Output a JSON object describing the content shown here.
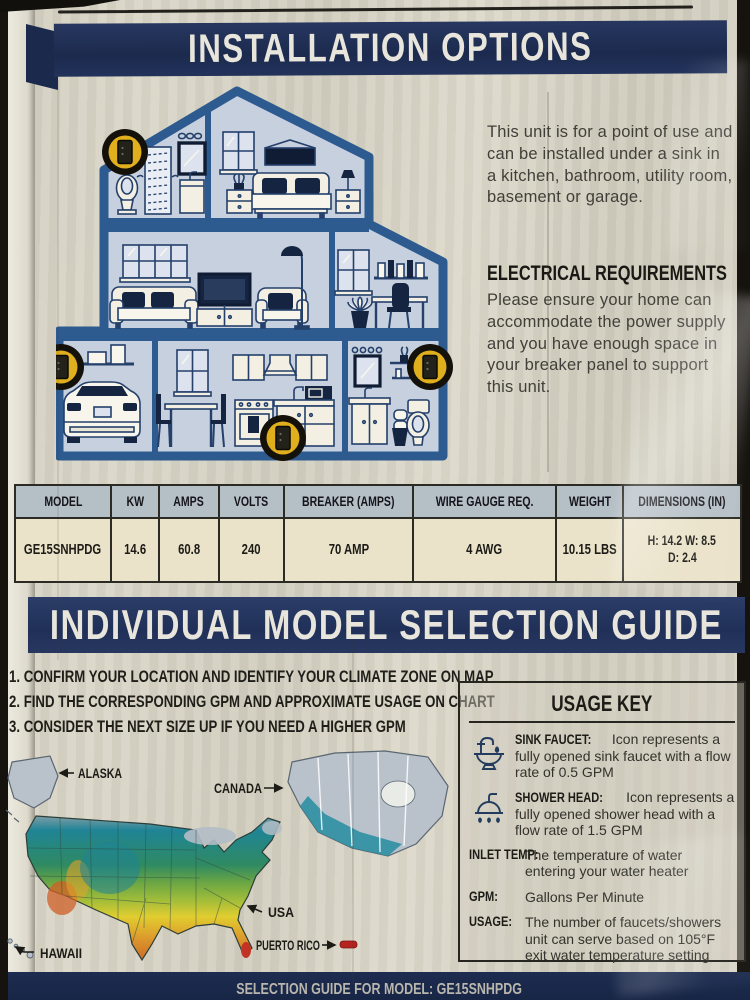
{
  "banners": {
    "installation": "INSTALLATION OPTIONS",
    "model_guide": "INDIVIDUAL MODEL SELECTION GUIDE",
    "bottom": "SELECTION GUIDE FOR MODEL: GE15SNHPDG"
  },
  "intro": {
    "text": "This unit is for a point of use and can be installed under a sink in a kitchen, bathroom, utility room, basement or garage."
  },
  "electrical": {
    "heading": "ELECTRICAL REQUIREMENTS",
    "text": "Please ensure your home can accommodate the power supply and you have enough space in your breaker panel to support this unit."
  },
  "spec_table": {
    "columns": [
      "MODEL",
      "KW",
      "AMPS",
      "VOLTS",
      "BREAKER (AMPS)",
      "WIRE GAUGE REQ.",
      "WEIGHT",
      "DIMENSIONS (IN)"
    ],
    "row": [
      "GE15SNHPDG",
      "14.6",
      "60.8",
      "240",
      "70 AMP",
      "4 AWG",
      "10.15 LBS"
    ],
    "dimensions": {
      "line1": "H: 14.2 W: 8.5",
      "line2": "D: 2.4"
    }
  },
  "steps": {
    "items": [
      {
        "num": "1.",
        "text": "CONFIRM YOUR LOCATION AND IDENTIFY YOUR CLIMATE ZONE ON MAP"
      },
      {
        "num": "2.",
        "text": "FIND THE CORRESPONDING GPM AND APPROXIMATE USAGE ON CHART"
      },
      {
        "num": "3.",
        "text": "CONSIDER THE NEXT SIZE UP IF YOU NEED A HIGHER GPM"
      }
    ]
  },
  "map": {
    "labels": {
      "alaska": "ALASKA",
      "canada": "CANADA",
      "usa": "USA",
      "puerto_rico": "PUERTO RICO",
      "hawaii": "HAWAII"
    }
  },
  "usage_key": {
    "title": "USAGE KEY",
    "items": [
      {
        "icon": "sink-faucet",
        "label": "SINK FAUCET:",
        "text": "Icon represents a fully opened sink faucet with a flow rate of 0.5 GPM"
      },
      {
        "icon": "shower-head",
        "label": "SHOWER HEAD:",
        "text": "Icon represents a fully opened shower head with a flow rate of 1.5 GPM"
      },
      {
        "icon": null,
        "label": "INLET TEMP:",
        "text": "The temperature of water entering your water heater"
      },
      {
        "icon": null,
        "label": "GPM:",
        "text": "Gallons Per Minute"
      },
      {
        "icon": null,
        "label": "USAGE:",
        "text": "The number of faucets/showers unit can serve based on 105°F exit water temperature setting"
      }
    ]
  },
  "colors": {
    "banner_navy": "#1c2a4e",
    "house_outline": "#2d5a8f",
    "badge_yellow": "#e0af1e",
    "map_teal": "#1f8496",
    "map_green": "#5d9a43",
    "map_yellow": "#e1cd30",
    "map_orange": "#dd9c2c",
    "map_red": "#c23325"
  }
}
